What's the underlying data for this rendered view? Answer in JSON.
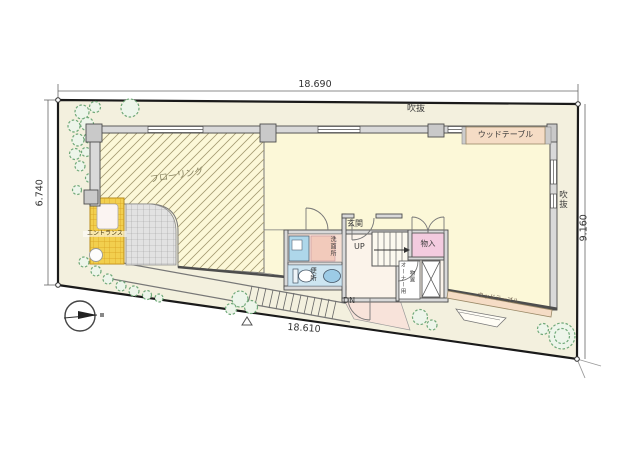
{
  "plan": {
    "title": "2F site / floor plan",
    "dimensions": {
      "top": "18.690",
      "left": "6.740",
      "right": "9.160",
      "bottom": "18.610"
    },
    "labels": {
      "void_top": "吹抜",
      "void_right": "吹抜",
      "wood_table_top": "ウッドテーブル",
      "wood_table_bottom": "ウッドテーブル",
      "flooring": "フローリング",
      "entrance_porch": "エントランス",
      "entrance_hall": "玄関",
      "stairs_up": "UP",
      "stairs_down": "DN",
      "closet": "物入",
      "toilet": "便所",
      "washroom": "洗面所",
      "owner_storage_line1": "オーナー用",
      "owner_storage_line2": "物置"
    },
    "colors": {
      "site_fill": "#f3f0de",
      "room_fill": "#fcf8d8",
      "entrance_yellow": "#f2cf4e",
      "closet_pink": "#f3cbdf",
      "fixture_blue": "#aed7ea",
      "wood": "#f5dcc5",
      "tree_green": "#6fa878",
      "wall_gray": "#4d4d4d"
    }
  }
}
